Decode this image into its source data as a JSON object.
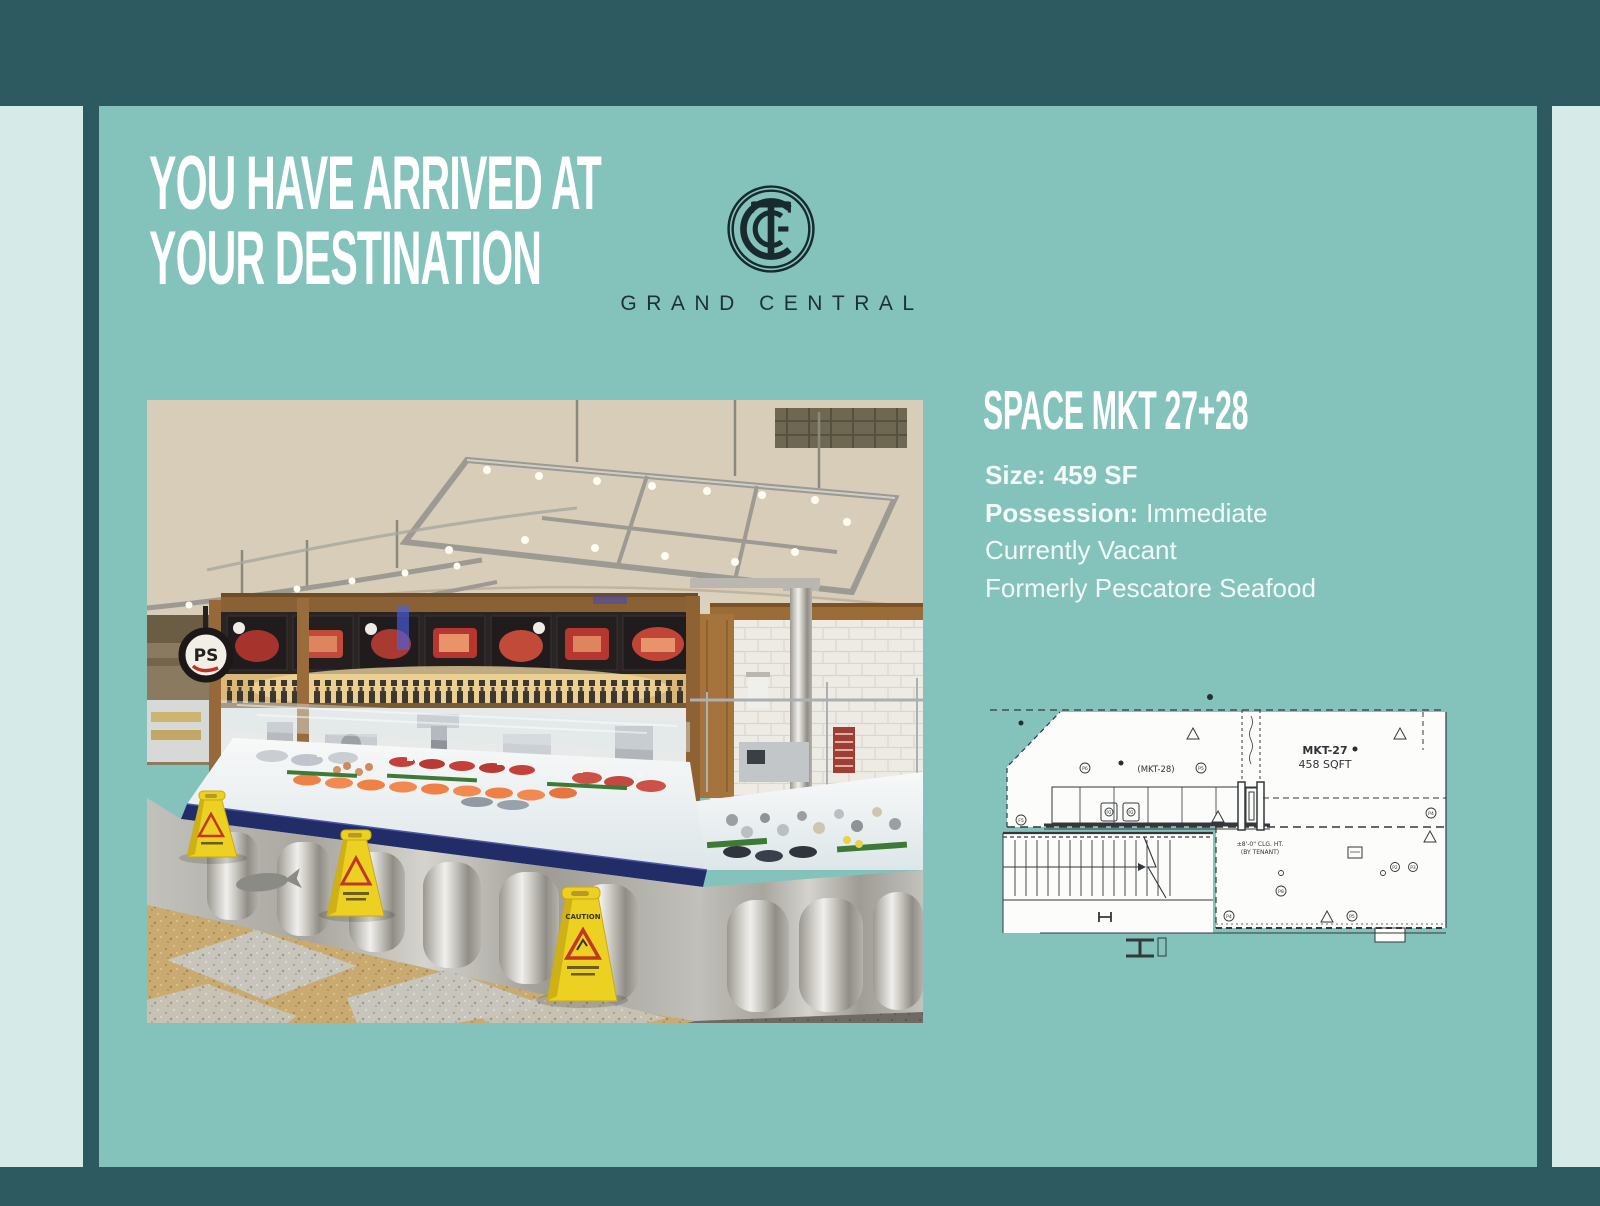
{
  "colors": {
    "background": "#2c5a60",
    "panel": "#84c3bc",
    "accent_strip": "#d6ebe8",
    "heading_text": "#ffffff",
    "body_text": "#f3faf8",
    "brand_text": "#1d3134"
  },
  "header": {
    "title_line1": "YOU HAVE ARRIVED AT",
    "title_line2": "YOUR DESTINATION"
  },
  "brand": {
    "name": "GRAND CENTRAL"
  },
  "listing": {
    "space_title": "SPACE MKT 27+28",
    "size_label": "Size:",
    "size_value": "459 SF",
    "possession_label": "Possession:",
    "possession_value": "Immediate",
    "status_line": "Currently Vacant",
    "history_line": "Formerly Pescatore Seafood"
  },
  "photo": {
    "ps_sign": "PS",
    "caution_sign": "CAUTION",
    "description": "Seafood market stall inside Grand Central Market: stainless display cases filled with iced fish, overhead track lighting, terrazzo floor and yellow wet-floor caution signs"
  },
  "floor_plan": {
    "room_a_label": "(MKT-28)",
    "room_b_name": "MKT-27",
    "room_b_area": "458 SQFT",
    "ceiling_note_line1": "±8'-0\" CLG. HT.",
    "ceiling_note_line2": "(BY TENANT)",
    "markers": [
      "F5",
      "P6",
      "P5",
      "P2",
      "P2",
      "P4",
      "P8",
      "P2",
      "P3",
      "P4",
      "P5"
    ]
  }
}
